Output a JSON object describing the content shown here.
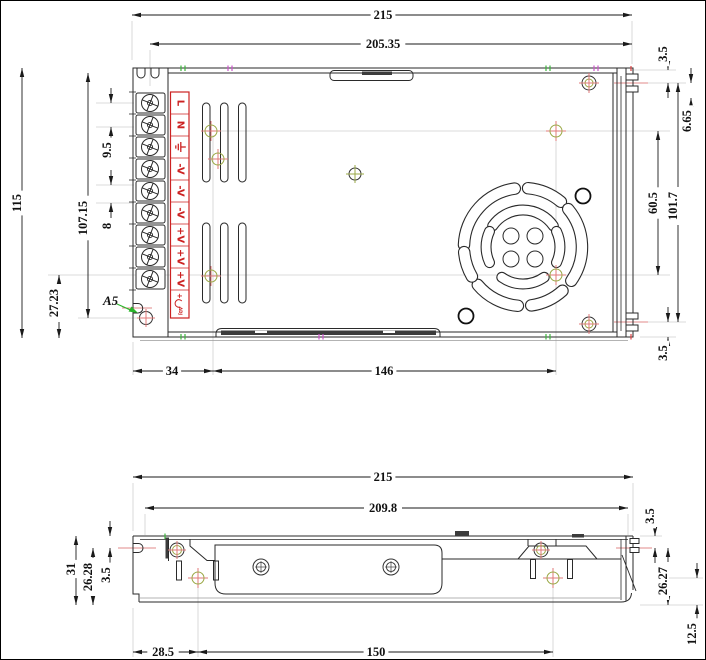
{
  "colors": {
    "line": "#2a2a2a",
    "dim_line": "#1a1a1a",
    "terminal_red": "#cc2222",
    "marker_cross_pink": "#e07a7a",
    "marker_green": "#9aa845",
    "callout_arrow_green": "#2ab52a",
    "faint_gray": "#cfcfcf",
    "centerline_red": "#e08a8a"
  },
  "top_view": {
    "overall_width": "215",
    "inner_width": "205.35",
    "overall_height": "115",
    "height_to_hole": "107.15",
    "terminal_offset": "9.5",
    "terminal_pitch": "8",
    "bottom_offset": "27.23",
    "hole_offset_x": "34",
    "hole_spacing_x": "146",
    "right_top": "3.5",
    "right_upper": "6.65",
    "fan_hole_spacing": "60.5",
    "right_span": "101.7",
    "right_bottom": "3.5"
  },
  "side_view": {
    "overall_width": "215",
    "inner_width": "209.8",
    "height": "31",
    "slot_to_bottom": "26.28",
    "top_to_slot": "3.5",
    "hole_offset_x": "28.5",
    "hole_spacing_x": "150",
    "right_top": "3.5",
    "right_slot_to_bottom": "26.27",
    "hole_to_bottom": "12.5"
  },
  "terminal_block": {
    "labels": [
      "L",
      "N",
      "⏚",
      "-V",
      "-V",
      "-V",
      "+V",
      "+V",
      "+V",
      "ADJ"
    ],
    "adj_plus": "+",
    "adj_label": "ADJ"
  },
  "callout": {
    "label": "A5"
  }
}
